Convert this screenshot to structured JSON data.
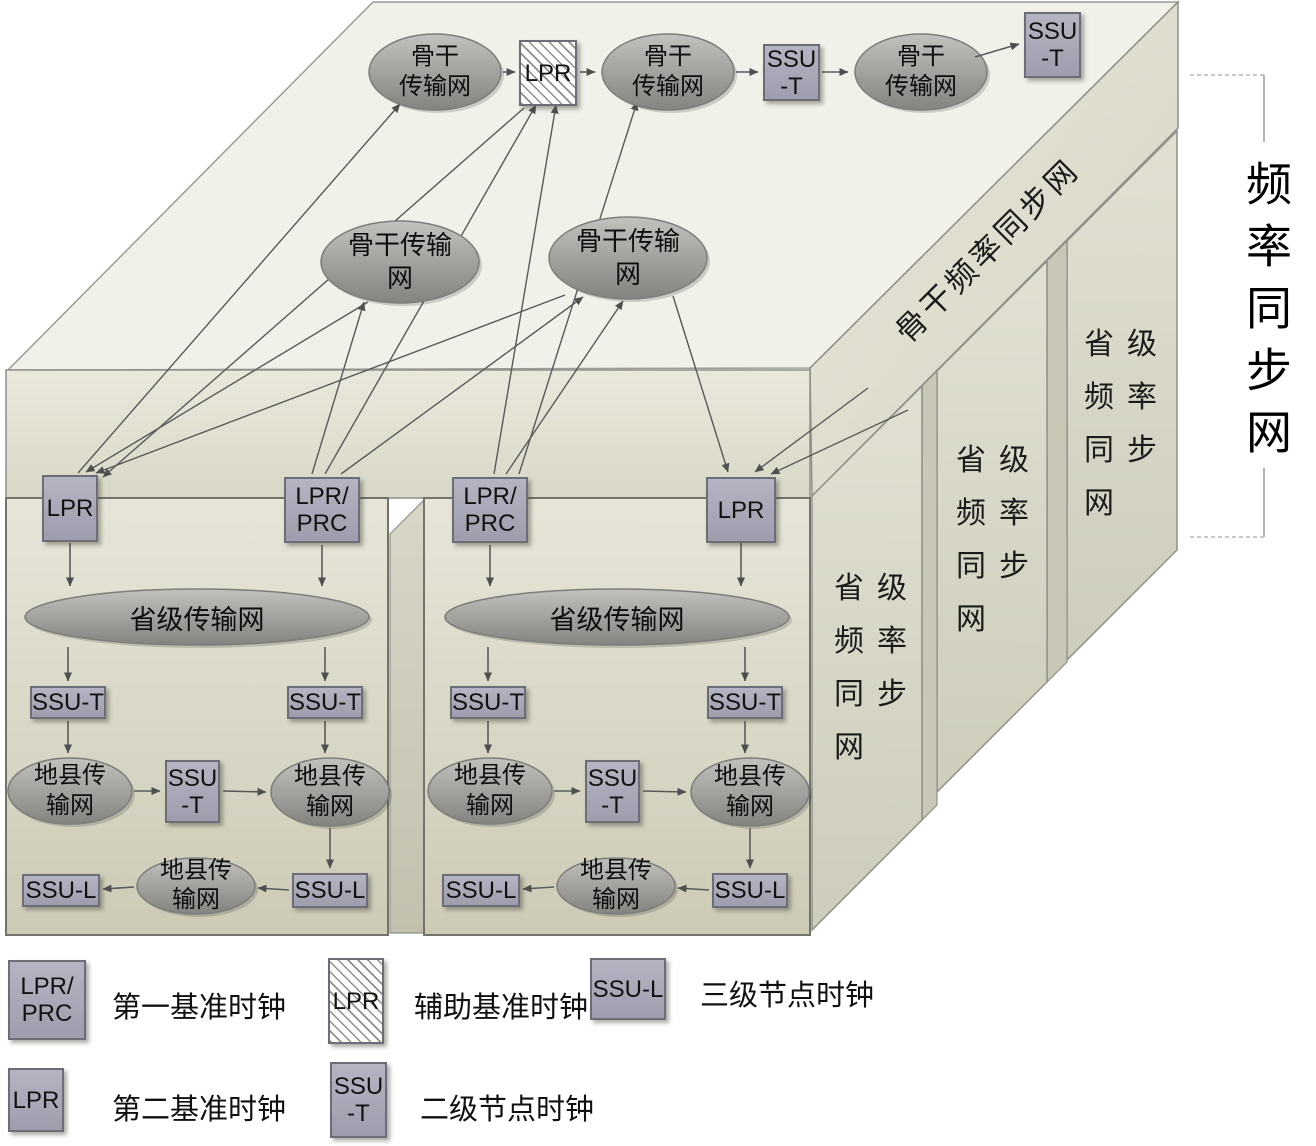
{
  "title": "频率同步网",
  "labels": {
    "lpr": "LPR",
    "lpr_slash": "LPR/",
    "prc": "PRC",
    "ssu_t": "SSU-T",
    "ssu": "SSU",
    "t": "-T",
    "ssu_l": "SSU-L",
    "backbone_l1": "骨干",
    "backbone_l2": "传输网",
    "backbone_w1": "骨干传输",
    "backbone_w2": "网",
    "provincial_net": "省级传输网",
    "county_l1": "地县传",
    "county_l2": "输网",
    "band": "骨干频率同步网",
    "slab_l1": "省级",
    "slab_l2": "频率",
    "slab_l3": "同步",
    "slab_l4": "网",
    "side_title": "频率同步网"
  },
  "legend": {
    "items": [
      {
        "box_line1": "LPR/",
        "box_line2": "PRC",
        "label": "第一基准时钟",
        "style": "solid"
      },
      {
        "box_line1": "LPR",
        "box_line2": "",
        "label": "辅助基准时钟",
        "style": "hatched"
      },
      {
        "box_line1": "SSU-L",
        "box_line2": "",
        "label": "三级节点时钟",
        "style": "solid"
      },
      {
        "box_line1": "LPR",
        "box_line2": "",
        "label": "第二基准时钟",
        "style": "solid"
      },
      {
        "box_line1": "SSU",
        "box_line2": "-T",
        "label": "二级节点时钟",
        "style": "solid"
      }
    ]
  },
  "colors": {
    "node_fill": "#a9a9b9",
    "node_border": "#6d6d77",
    "top_face": "#f1f0e9",
    "panel_top": "#e6e5d8",
    "panel_bottom": "#cdcbb6",
    "ellipse_top": "#c2c0bd",
    "ellipse_bottom": "#878582",
    "arrow": "#4f4f4f"
  }
}
